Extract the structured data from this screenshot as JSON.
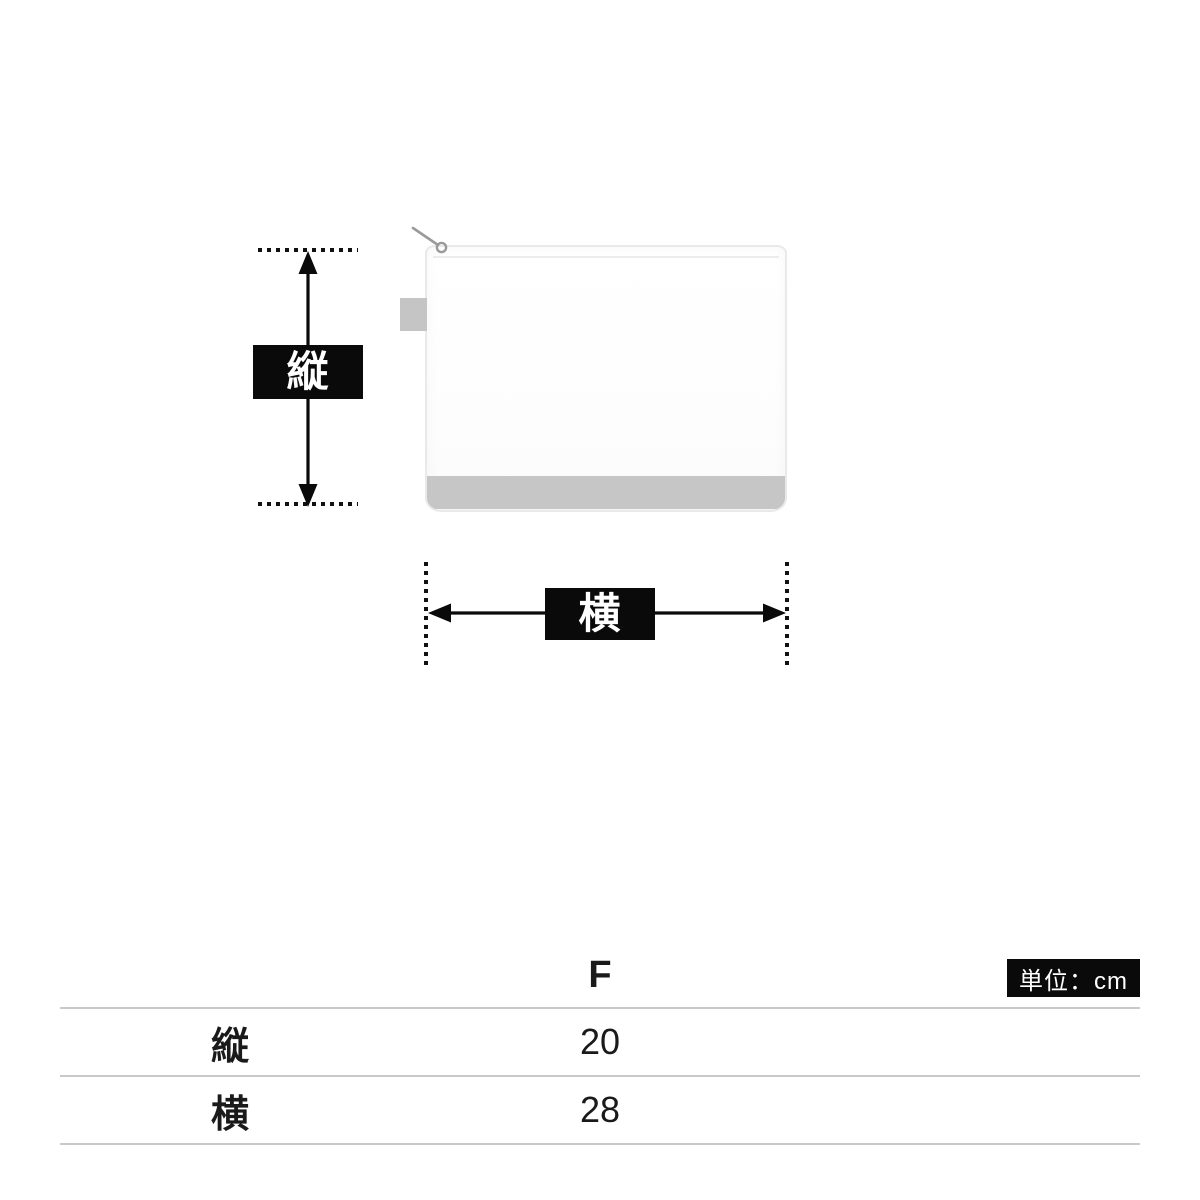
{
  "diagram": {
    "vertical_dimension_label": "縦",
    "horizontal_dimension_label": "横"
  },
  "table": {
    "size_column_header": "F",
    "unit_badge": "単位：cm",
    "rows": [
      {
        "label": "縦",
        "value": "20"
      },
      {
        "label": "横",
        "value": "28"
      }
    ]
  },
  "colors": {
    "label_box_bg": "#0a0a0a",
    "label_box_text": "#ffffff",
    "table_line": "#c9c9c9",
    "pouch_band_gray": "#c6c6c6",
    "pouch_outline": "#e9e9e9",
    "text": "#1a1a1a"
  }
}
